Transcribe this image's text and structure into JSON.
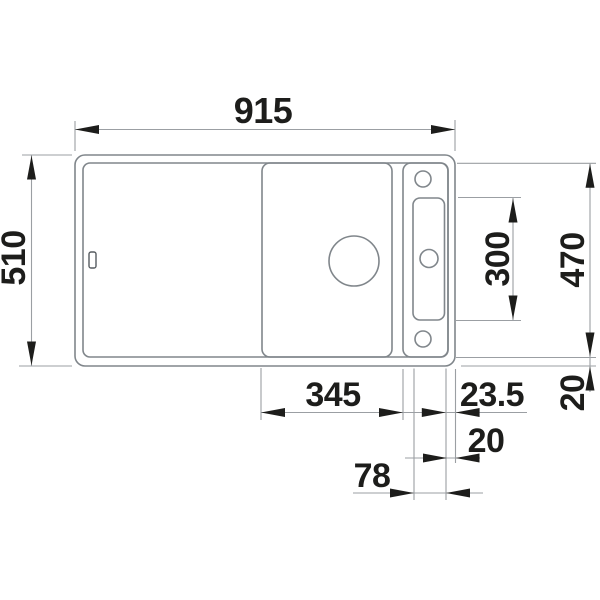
{
  "colors": {
    "background": "#ffffff",
    "object_line": "#80868b",
    "dimension_line": "#9b9fa3",
    "ink": "#1d1d1b"
  },
  "drawing": {
    "dimensions": {
      "overall_width": "915",
      "overall_depth": "510",
      "inner_depth": "470",
      "slot_height": "300",
      "rear_right_edge": "20",
      "board_section_width": "345",
      "slot_to_edge": "23.5",
      "right_edge": "20",
      "slot_width": "78"
    }
  }
}
